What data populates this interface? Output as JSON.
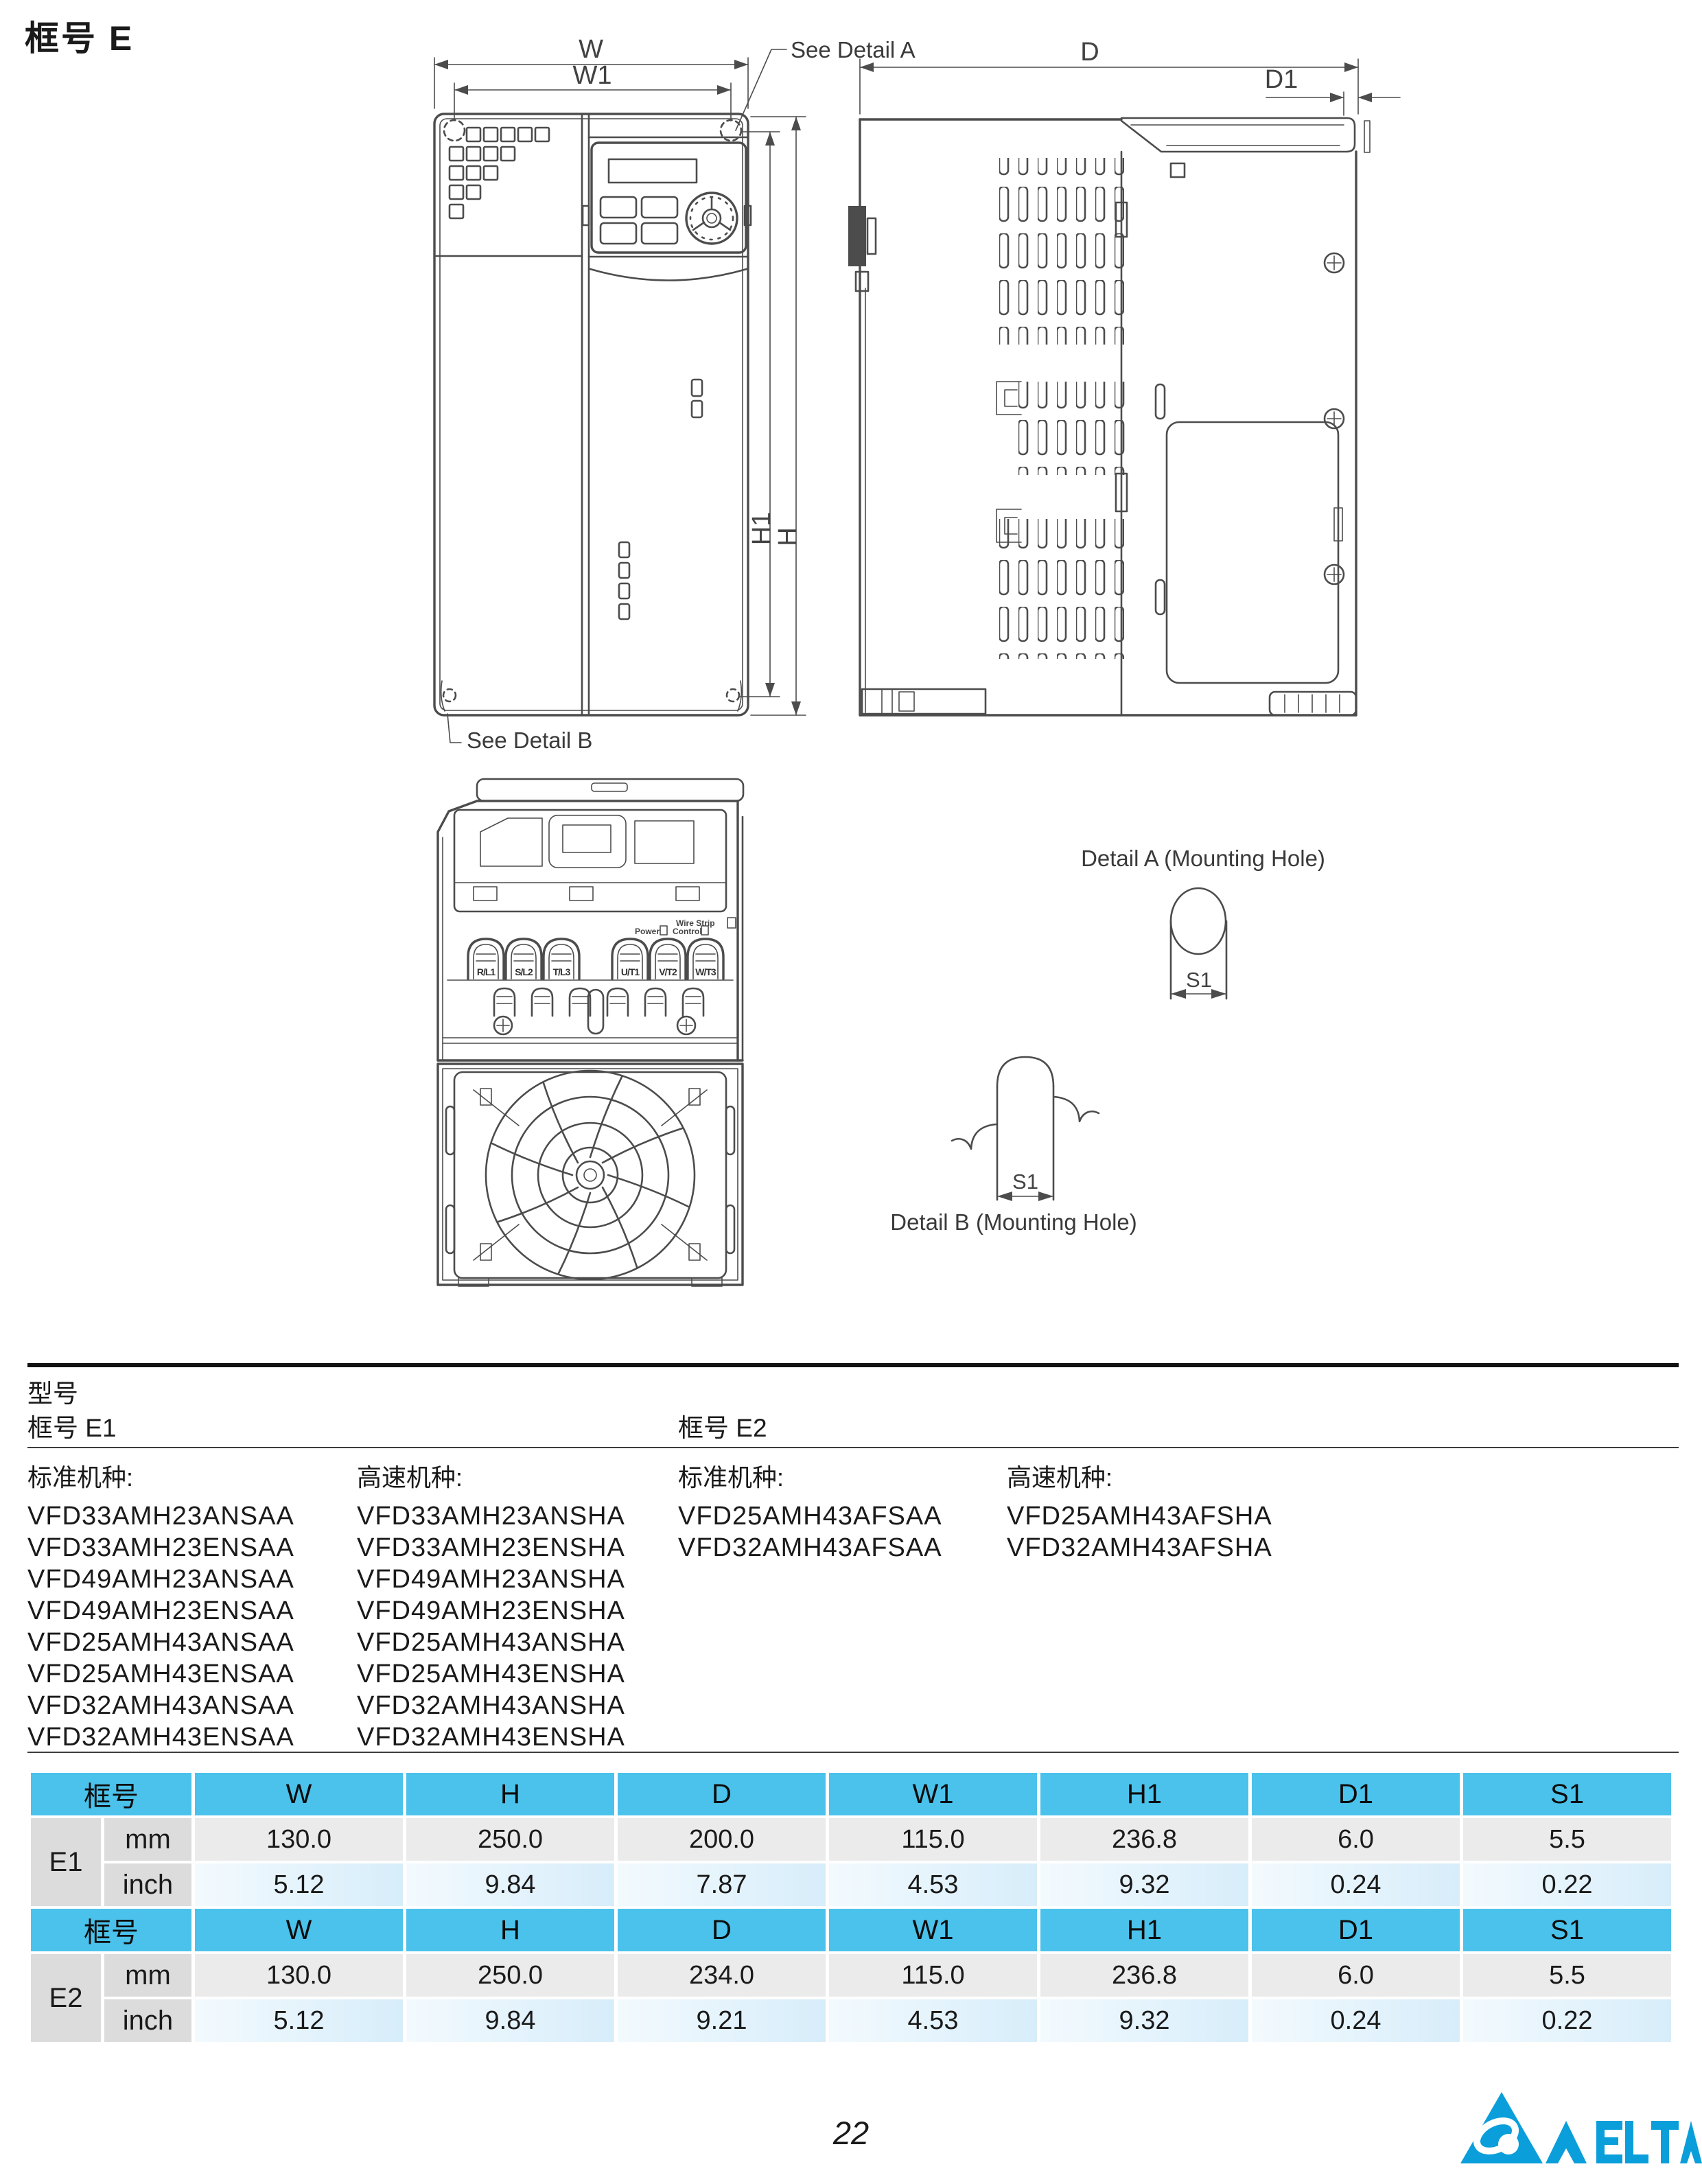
{
  "page": {
    "title": "框号 E",
    "page_number": "22",
    "logo_name": "DELTA"
  },
  "drawings": {
    "front_view": {
      "w": "W",
      "w1": "W1",
      "h": "H",
      "h1": "H1",
      "see_detail_a": "See Detail A",
      "see_detail_b": "See Detail B"
    },
    "side_view": {
      "d": "D",
      "d1": "D1"
    },
    "bottom_view": {
      "terminal_labels": [
        "R/L1",
        "S/L2",
        "T/L3",
        "U/T1",
        "V/T2",
        "W/T3"
      ],
      "wire_strip": "Wire Strip",
      "power": "Power",
      "control": "Control"
    },
    "detail_a": {
      "title": "Detail A (Mounting Hole)",
      "dim": "S1"
    },
    "detail_b": {
      "title": "Detail B (Mounting Hole)",
      "dim": "S1"
    }
  },
  "models": {
    "section_title": "型号",
    "frames": [
      {
        "title": "框号 E1",
        "columns": [
          {
            "header": "标准机种:",
            "items": [
              "VFD33AMH23ANSAA",
              "VFD33AMH23ENSAA",
              "VFD49AMH23ANSAA",
              "VFD49AMH23ENSAA",
              "VFD25AMH43ANSAA",
              "VFD25AMH43ENSAA",
              "VFD32AMH43ANSAA",
              "VFD32AMH43ENSAA"
            ]
          },
          {
            "header": "高速机种:",
            "items": [
              "VFD33AMH23ANSHA",
              "VFD33AMH23ENSHA",
              "VFD49AMH23ANSHA",
              "VFD49AMH23ENSHA",
              "VFD25AMH43ANSHA",
              "VFD25AMH43ENSHA",
              "VFD32AMH43ANSHA",
              "VFD32AMH43ENSHA"
            ]
          }
        ]
      },
      {
        "title": "框号 E2",
        "columns": [
          {
            "header": "标准机种:",
            "items": [
              "VFD25AMH43AFSAA",
              "VFD32AMH43AFSAA"
            ]
          },
          {
            "header": "高速机种:",
            "items": [
              "VFD25AMH43AFSHA",
              "VFD32AMH43AFSHA"
            ]
          }
        ]
      }
    ]
  },
  "dim_table": {
    "col_headers": [
      "框号",
      "W",
      "H",
      "D",
      "W1",
      "H1",
      "D1",
      "S1"
    ],
    "sections": [
      {
        "frame": "E1",
        "rows": [
          {
            "unit": "mm",
            "values": [
              "130.0",
              "250.0",
              "200.0",
              "115.0",
              "236.8",
              "6.0",
              "5.5"
            ]
          },
          {
            "unit": "inch",
            "values": [
              "5.12",
              "9.84",
              "7.87",
              "4.53",
              "9.32",
              "0.24",
              "0.22"
            ]
          }
        ]
      },
      {
        "frame": "E2",
        "rows": [
          {
            "unit": "mm",
            "values": [
              "130.0",
              "250.0",
              "234.0",
              "115.0",
              "236.8",
              "6.0",
              "5.5"
            ]
          },
          {
            "unit": "inch",
            "values": [
              "5.12",
              "9.84",
              "9.21",
              "4.53",
              "9.32",
              "0.24",
              "0.22"
            ]
          }
        ]
      }
    ],
    "colors": {
      "header_bg": "#4AC2EB",
      "label_bg": "#DCDCDC",
      "mm_bg": "#EBEBEB",
      "inch_bg": "#D7EDFA"
    }
  }
}
